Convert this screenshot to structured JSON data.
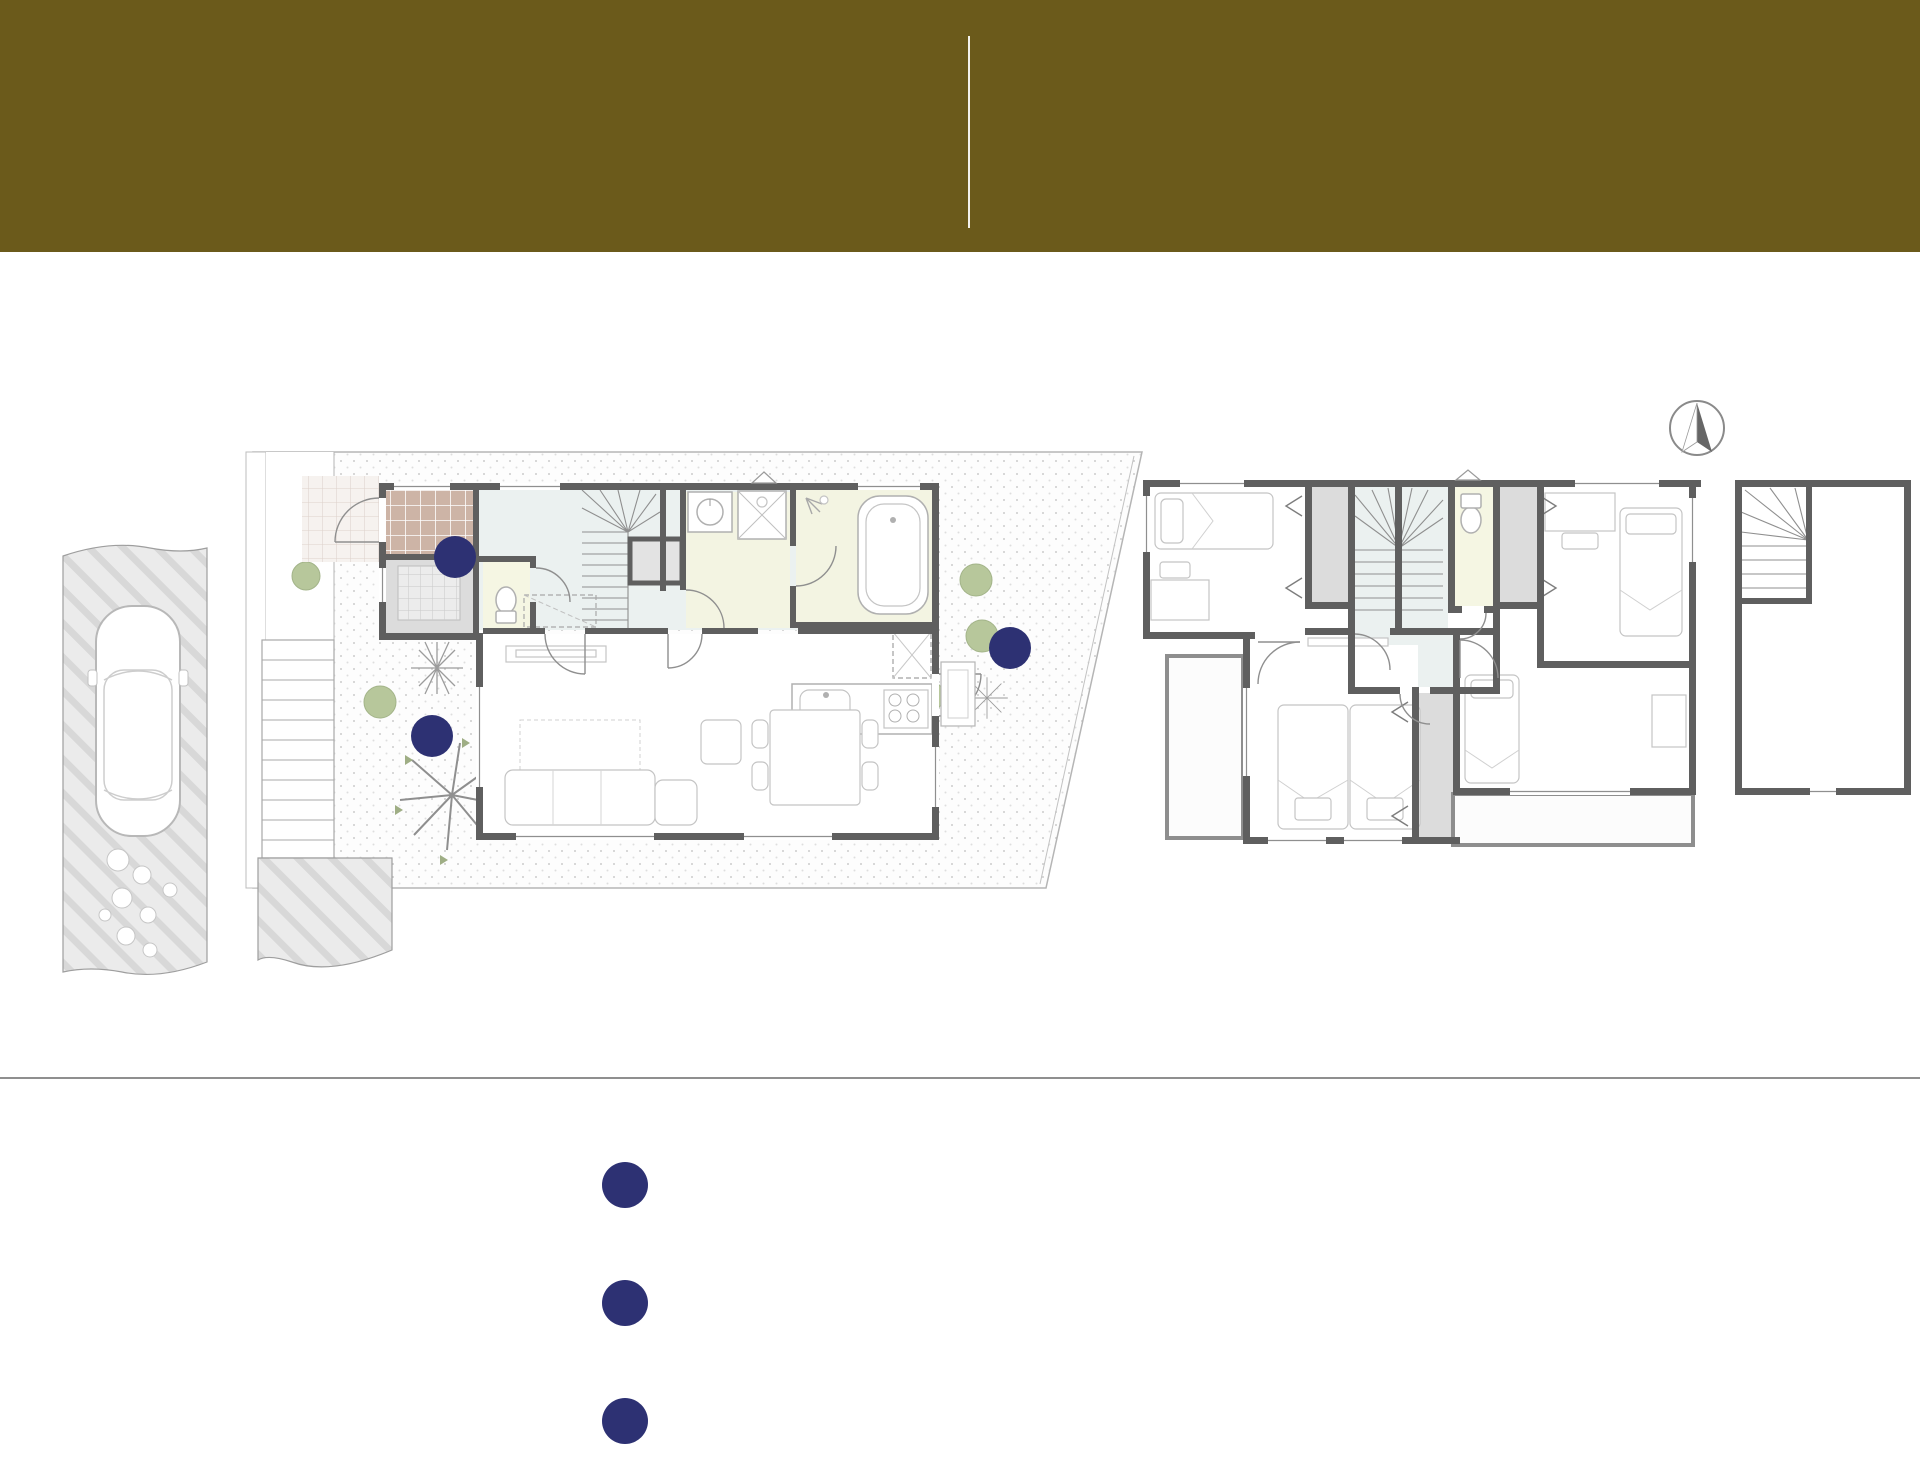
{
  "header": {
    "bg_color": "#6B5A1B",
    "left": {
      "line1": "条件付き土地",
      "line2": "referencePLAN",
      "line3": "No.3区画"
    },
    "right": {
      "plan_big": "4",
      "plan_rest": "LDK+SIC+STEPCABIN",
      "site_label": "敷地面積／",
      "site_value": "135.37",
      "site_unit": "m",
      "site_sup": "2",
      "site_tsubo": "（約40.94坪）",
      "bldg_label": "建物面積／",
      "bldg_value": "107.64",
      "bldg_unit": "m",
      "bldg_sup": "2",
      "bldg_tsubo": "（約32.56坪）"
    }
  },
  "plans": {
    "f1": {
      "label": "1F",
      "ent": "Ent.",
      "sic": "SIC",
      "hall": "Hall",
      "wc": "WC",
      "up": "UP",
      "sto": "Sto.",
      "powder1": "Powder",
      "powder2": "Room",
      "ub1": "UB",
      "ub2": "1616",
      "fridge": "R",
      "ldk1": "Living Dining",
      "ldk2": "Kitchen",
      "ldk3": "19.0J"
    },
    "f2": {
      "label": "2F",
      "room": "Room",
      "s53": "5.3J",
      "s70": "7.0J",
      "s60": "6.0J",
      "clo": "Clo.",
      "wc": "WC",
      "up": "UP",
      "dn": "DN",
      "bal": "Bal.",
      "balcony": "Balcony"
    },
    "stepcabin": {
      "name": "Stepcabin",
      "size": "6.1J",
      "dn": "DN"
    },
    "compass_n": "N",
    "badge1": "1",
    "badge2": "2",
    "badge3": "3"
  },
  "pickup": {
    "title": "【PLAN PICK UP】",
    "items": [
      {
        "num": "1",
        "text": "西側の開放感のある箇所にガーデンスペースを確保"
      },
      {
        "num": "2",
        "text": "勝手口を設置し、キッチンの家事効率をUP"
      },
      {
        "num": "3",
        "text": "コの字型の使い勝手の良いシューズクロークを完備"
      }
    ]
  },
  "colors": {
    "header_bg": "#6B5A1B",
    "badge_navy": "#2D3173",
    "wall": "#5F5F5F",
    "room_cream": "#F3F4E2",
    "entry_tile": "#CDB4A6",
    "closet_gray": "#DCDCDC",
    "hall_blue": "#EBF1F0",
    "tree_green": "#B7C79B"
  }
}
